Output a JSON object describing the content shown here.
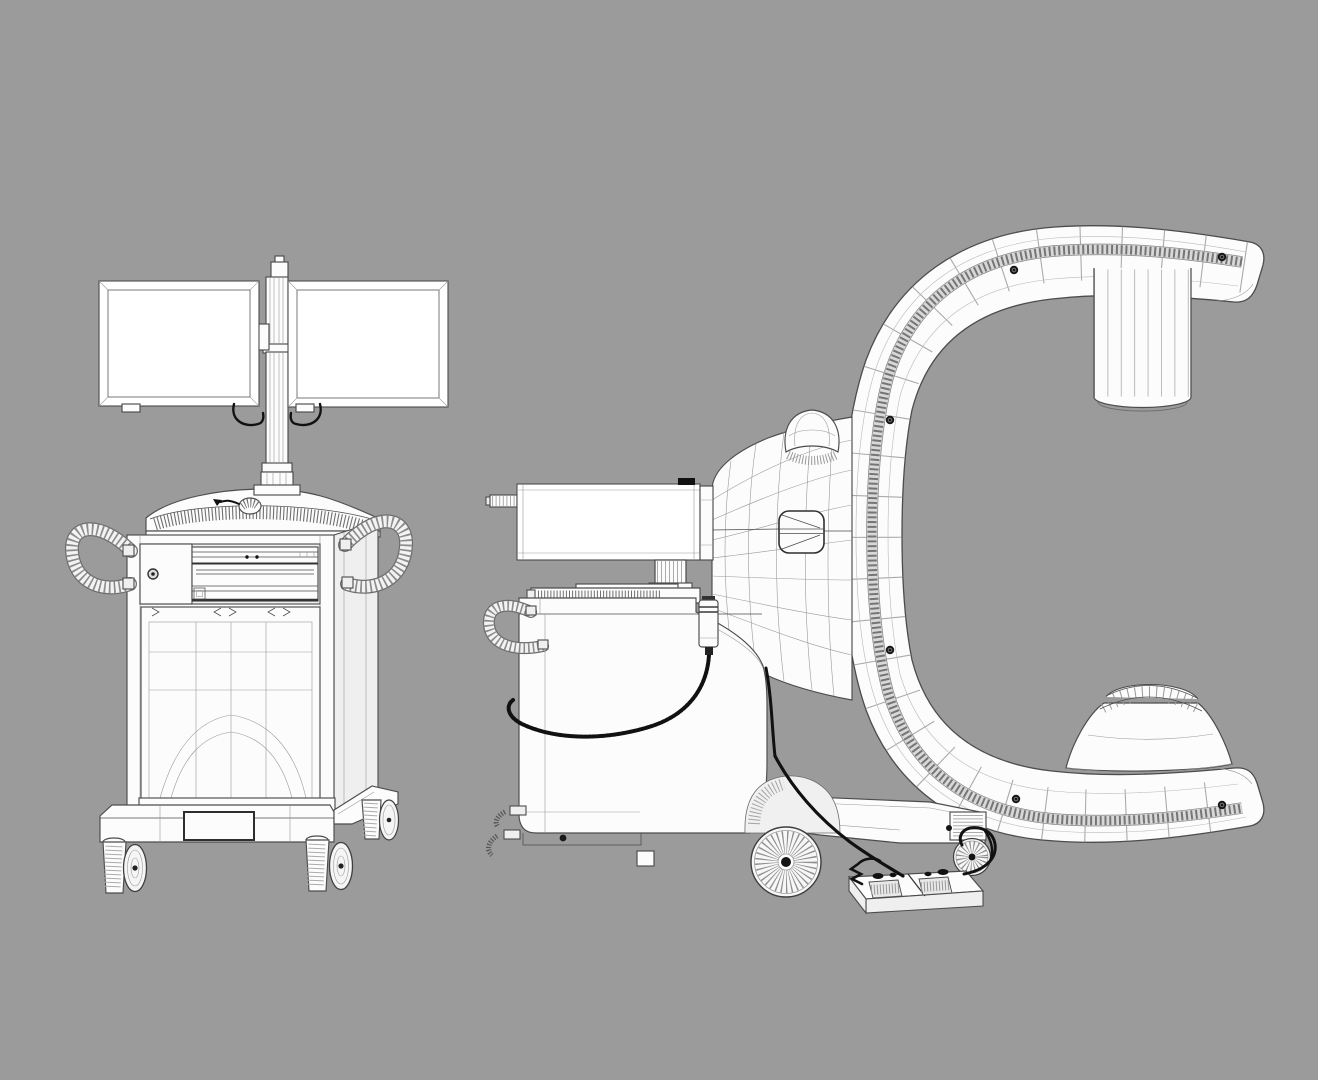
{
  "scene": {
    "title": "Mobile C-arm X-ray system — 3D wireframe model, two views",
    "colors": {
      "background": "#9b9b9b",
      "model-fill": "#fcfcfc",
      "model-shade": "#efefef",
      "wire": "#4c4c4c",
      "wire-light": "#9a9a9a",
      "rib": "#6f6f6f",
      "cable": "#111111",
      "screen": "#ffffff",
      "bolt": "#161616"
    }
  },
  "views": {
    "front_cart": {
      "label": "Monitor cart — front wireframe view",
      "parts": {
        "monitor_left": {
          "label": "Left display monitor"
        },
        "monitor_right": {
          "label": "Right display monitor"
        },
        "monitor_pole": {
          "label": "Monitor mounting pole"
        },
        "monitor_cable": {
          "label": "Monitor cable loop"
        },
        "keyboard_deck": {
          "label": "Keyboard work surface"
        },
        "mouse": {
          "label": "Mouse with cable"
        },
        "cabinet": {
          "label": "Equipment cabinet"
        },
        "drawer_unit": {
          "label": "Recessed drawer and printer bay"
        },
        "power_button": {
          "label": "Power button"
        },
        "front_panel": {
          "label": "Lower front panel"
        },
        "handle_left": {
          "label": "Left coiled handle"
        },
        "handle_right": {
          "label": "Right coiled handle"
        },
        "base": {
          "label": "Cart base"
        },
        "casters": {
          "label": "Swivel casters"
        }
      }
    },
    "side_carm": {
      "label": "Mobile C-arm unit — side wireframe view",
      "parts": {
        "flat_display": {
          "label": "Flat display, edge-on"
        },
        "display_stand": {
          "label": "Display stand"
        },
        "control_console": {
          "label": "Control console keyboard"
        },
        "horn_housing": {
          "label": "Horizontal arm housing"
        },
        "dome_knob": {
          "label": "Dome knob"
        },
        "service_panel": {
          "label": "Service panel"
        },
        "hand_switch": {
          "label": "Hand switch with coiled cord"
        },
        "chassis": {
          "label": "Main chassis"
        },
        "chassis_handle": {
          "label": "Coiled steering handle"
        },
        "c_gantry": {
          "label": "C-shaped gantry"
        },
        "gantry_rail": {
          "label": "Gantry guide rail with bolts"
        },
        "image_intensifier": {
          "label": "Image intensifier cylinder"
        },
        "xray_tube": {
          "label": "X-ray tube housing cone"
        },
        "drive_wheel": {
          "label": "Main drive wheel"
        },
        "rear_wheel": {
          "label": "Rear wheel"
        },
        "rear_leg": {
          "label": "Rear support leg"
        },
        "foot_pedal": {
          "label": "Dual foot pedal"
        },
        "cables": {
          "label": "Interconnect cables"
        }
      }
    }
  }
}
